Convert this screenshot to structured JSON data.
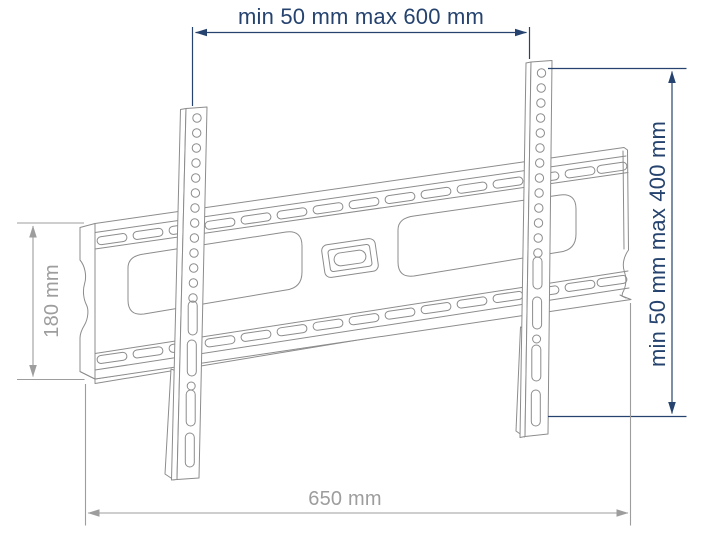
{
  "diagram": {
    "subject": "tv-wall-mount-bracket",
    "dimensions": {
      "top": {
        "label": "min 50 mm max 600 mm"
      },
      "right": {
        "label": "min 50 mm max 400 mm"
      },
      "left": {
        "label": "180 mm"
      },
      "bottom": {
        "label": "650 mm"
      }
    }
  },
  "colors": {
    "annotation_accent": "#25436e",
    "annotation_gray": "#9d9d9d",
    "outline": "#8c8c8c",
    "background": "#ffffff"
  }
}
